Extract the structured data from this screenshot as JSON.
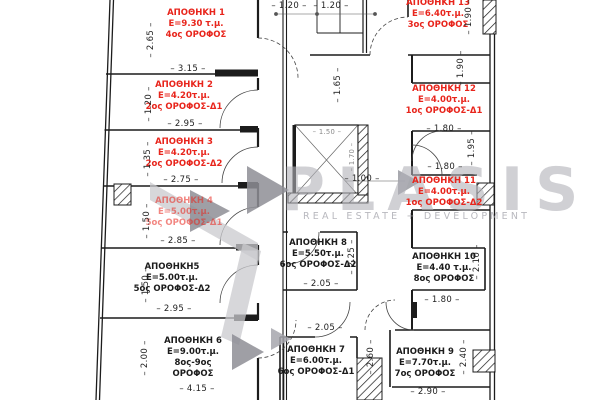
{
  "colors": {
    "accent_red": "#e8251c",
    "ink": "#1c1c1c",
    "watermark_gray": "#b0b0b8"
  },
  "watermark": {
    "brand": "PLASIS",
    "tagline": "REAL ESTATE + DEVELOPMENT"
  },
  "units": [
    {
      "name": "ΑΠΟΘΗΚΗ 1",
      "area": "Ε=9.30 τ.μ.",
      "floor": "4ος ΟΡΟΦΟΣ",
      "color": "red",
      "x": 196,
      "y": 8
    },
    {
      "name": "ΑΠΟΘΗΚΗ 2",
      "area": "Ε=4.20τ.μ.",
      "floor": "2ος ΟΡΟΦΟΣ-Δ1",
      "color": "red",
      "x": 184,
      "y": 80
    },
    {
      "name": "ΑΠΟΘΗΚΗ 3",
      "area": "Ε=4.20τ.μ.",
      "floor": "2ος ΟΡΟΦΟΣ-Δ2",
      "color": "red",
      "x": 184,
      "y": 137
    },
    {
      "name": "ΑΠΟΘΗΚΗ 4",
      "area": "Ε=5.00τ.μ.",
      "floor": "5ος ΟΡΟΦΟΣ-Δ1",
      "color": "red",
      "dimmed": true,
      "x": 184,
      "y": 196
    },
    {
      "name": "ΑΠΟΘΗΚΗ5",
      "area": "Ε=5.00τ.μ.",
      "floor": "5ος ΟΡΟΦΟΣ-Δ2",
      "color": "black",
      "x": 172,
      "y": 262
    },
    {
      "name": "ΑΠΟΘΗΚΗ 6",
      "area": "Ε=9.00τ.μ.",
      "floor": "8ος-9ος",
      "floor2": "ΟΡΟΦΟΣ",
      "color": "black",
      "x": 193,
      "y": 336
    },
    {
      "name": "ΑΠΟΘΗΚΗ 7",
      "area": "Ε=6.00τ.μ.",
      "floor": "6ος ΟΡΟΦΟΣ-Δ1",
      "color": "black",
      "x": 316,
      "y": 345
    },
    {
      "name": "ΑΠΟΘΗΚΗ 8",
      "area": "Ε=5.50τ.μ.",
      "floor": "6ος ΟΡΟΦΟΣ-Δ2",
      "color": "black",
      "x": 318,
      "y": 238
    },
    {
      "name": "ΑΠΟΘΗΚΗ 9",
      "area": "Ε=7.70τ.μ.",
      "floor": "7ος ΟΡΟΦΟΣ",
      "color": "black",
      "x": 425,
      "y": 347
    },
    {
      "name": "ΑΠΟΘΗΚΗ 10",
      "area": "Ε=4.40 τ.μ.",
      "floor": "8ος ΟΡΟΦΟΣ",
      "color": "black",
      "x": 444,
      "y": 252
    },
    {
      "name": "ΑΠΟΘΗΚΗ 11",
      "area": "Ε=4.00τ.μ.",
      "floor": "1ος ΟΡΟΦΟΣ-Δ2",
      "color": "red",
      "x": 444,
      "y": 176
    },
    {
      "name": "ΑΠΟΘΗΚΗ 12",
      "area": "Ε=4.00τ.μ.",
      "floor": "1ος ΟΡΟΦΟΣ-Δ1",
      "color": "red",
      "x": 444,
      "y": 84
    },
    {
      "name": "ΑΠΟΘΗΚΗ 13",
      "area": "Ε=6.40τ.μ.",
      "floor": "3ος ΟΡΟΦΟΣ",
      "color": "red",
      "x": 438,
      "y": -2
    }
  ],
  "dims": [
    {
      "v": "2.65",
      "x": 151,
      "y": 40,
      "r": true
    },
    {
      "v": "1.20",
      "x": 149,
      "y": 104,
      "r": true
    },
    {
      "v": "1.35",
      "x": 148,
      "y": 159,
      "r": true
    },
    {
      "v": "1.50",
      "x": 147,
      "y": 221,
      "r": true
    },
    {
      "v": "1.50",
      "x": 146,
      "y": 285,
      "r": true
    },
    {
      "v": "2.00",
      "x": 145,
      "y": 358,
      "r": true
    },
    {
      "v": "3.15",
      "x": 188,
      "y": 69
    },
    {
      "v": "2.95",
      "x": 185,
      "y": 124
    },
    {
      "v": "2.75",
      "x": 181,
      "y": 180
    },
    {
      "v": "2.85",
      "x": 178,
      "y": 241
    },
    {
      "v": "2.95",
      "x": 174,
      "y": 309
    },
    {
      "v": "4.15",
      "x": 197,
      "y": 389
    },
    {
      "v": "1.20",
      "x": 289,
      "y": 6
    },
    {
      "v": "1.20",
      "x": 331,
      "y": 6
    },
    {
      "v": "1.65",
      "x": 338,
      "y": 85,
      "r": true
    },
    {
      "v": "1.50",
      "x": 327,
      "y": 132,
      "small": true
    },
    {
      "v": "1.70",
      "x": 352,
      "y": 157,
      "r": true,
      "small": true
    },
    {
      "v": "1.00",
      "x": 362,
      "y": 179
    },
    {
      "v": "2.25",
      "x": 352,
      "y": 257,
      "r": true
    },
    {
      "v": "2.05",
      "x": 321,
      "y": 284
    },
    {
      "v": "2.05",
      "x": 325,
      "y": 328
    },
    {
      "v": "2.60",
      "x": 371,
      "y": 357,
      "r": true
    },
    {
      "v": "1.90",
      "x": 469,
      "y": 17,
      "r": true
    },
    {
      "v": "1.90",
      "x": 461,
      "y": 68,
      "r": true
    },
    {
      "v": "1.80",
      "x": 444,
      "y": 129
    },
    {
      "v": "1.95",
      "x": 472,
      "y": 148,
      "r": true
    },
    {
      "v": "1.80",
      "x": 445,
      "y": 167
    },
    {
      "v": "2.10",
      "x": 477,
      "y": 262,
      "r": true
    },
    {
      "v": "1.80",
      "x": 442,
      "y": 300
    },
    {
      "v": "2.40",
      "x": 464,
      "y": 357,
      "r": true
    },
    {
      "v": "2.90",
      "x": 428,
      "y": 392
    }
  ]
}
